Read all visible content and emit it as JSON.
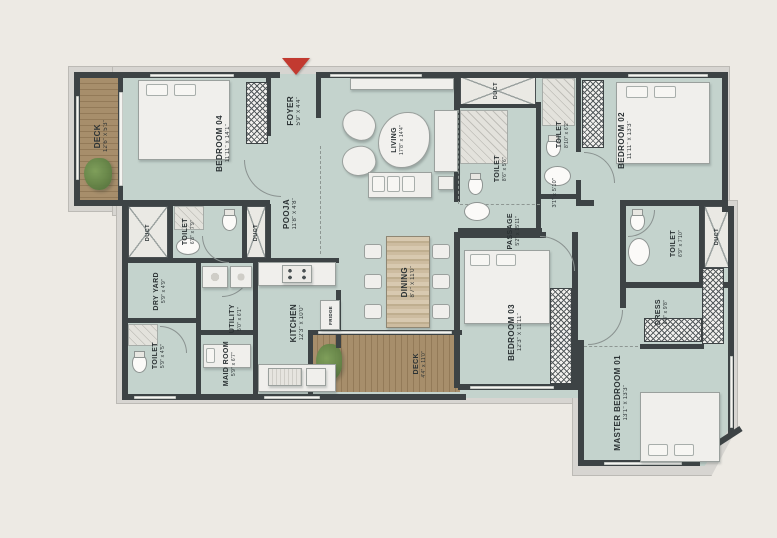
{
  "plan": {
    "colors": {
      "background": "#edeae4",
      "room_fill": "#c4d3cd",
      "wall": "#3d4345",
      "deck_wood": "#a78e6b",
      "outer_band": "#d7d5d1",
      "entry_arrow": "#c23a30",
      "label_text": "#2b3234"
    },
    "rooms": {
      "deck_top": {
        "label": "DECK",
        "dims": "12'6\" x 5'3\""
      },
      "bedroom_04": {
        "label": "BEDROOM 04",
        "dims": "11'11\" x 14'1\""
      },
      "foyer": {
        "label": "FOYER",
        "dims": "5'9\" x 4'4\""
      },
      "living": {
        "label": "LIVING",
        "dims": "17'8\" x 14'4\""
      },
      "pooja": {
        "label": "POOJA",
        "dims": "11'8\" x 4'8\""
      },
      "toilet_bed04": {
        "label": "TOILET",
        "dims": "6'8\" x 7'9\""
      },
      "duct_left_a": {
        "label": "DUCT"
      },
      "duct_left_b": {
        "label": "DUCT"
      },
      "dry_yard": {
        "label": "DRY YARD",
        "dims": "5'9\" x 4'9\""
      },
      "utility": {
        "label": "UTILITY",
        "dims": "5'0\" x 6'1\""
      },
      "toilet_maid": {
        "label": "TOILET",
        "dims": "5'9\" x 4'5\""
      },
      "maid_room": {
        "label": "MAID ROOM",
        "dims": "5'9\" x 6'7\""
      },
      "kitchen": {
        "label": "KITCHEN",
        "dims": "12'3\" x 10'0\""
      },
      "fridge": {
        "label": "FRIDGE"
      },
      "dining": {
        "label": "DINING",
        "dims": "8'7\" x 11'0\""
      },
      "deck_bottom": {
        "label": "DECK",
        "dims": "4'4\" x 11'0\""
      },
      "duct_top": {
        "label": "DUCT"
      },
      "toilet_common": {
        "label": "TOILET",
        "dims": "8'6\" x 5'6\""
      },
      "toilet_bed02": {
        "label": "TOILET",
        "dims": "8'10\" x 6'2\""
      },
      "bedroom_02": {
        "label": "BEDROOM 02",
        "dims": "11'11\" x 13'3\""
      },
      "passage": {
        "label": "PASSAGE",
        "dims": "5'2\" x 15'11\""
      },
      "niche": {
        "dims": "3'1\" x 5'10\""
      },
      "bedroom_03": {
        "label": "BEDROOM 03",
        "dims": "12'3\" x 11'11\""
      },
      "toilet_master": {
        "label": "TOILET",
        "dims": "6'9\" x 7'10\""
      },
      "duct_right": {
        "label": "DUCT"
      },
      "dress": {
        "label": "DRESS",
        "dims": "6'8\" x 9'8\""
      },
      "master_bedroom": {
        "label": "MASTER BEDROOM 01",
        "dims": "13'1\" x 13'3\""
      }
    }
  }
}
